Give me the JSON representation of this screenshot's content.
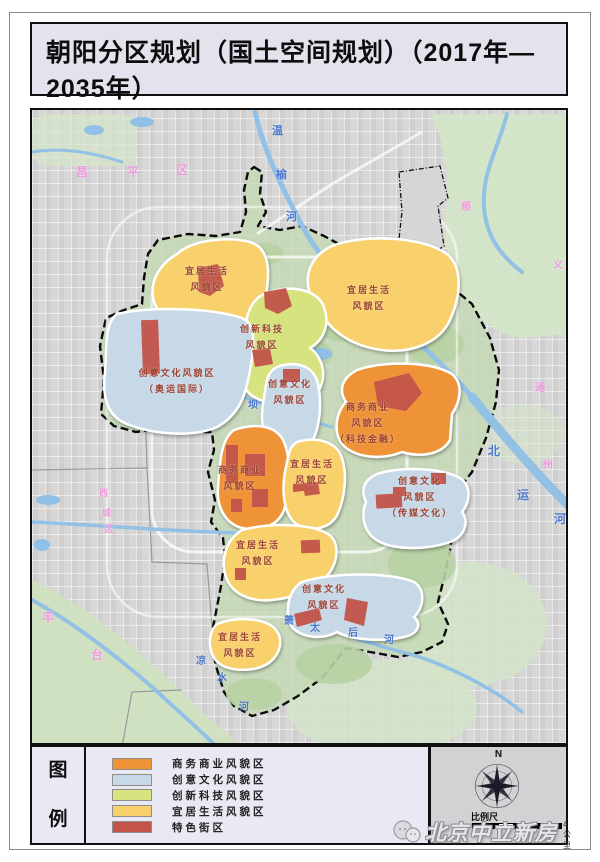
{
  "page": {
    "title": "朝阳分区规划（国土空间规划）（2017年—2035年）",
    "subtitle": "图15 风貌分区规划图"
  },
  "legend": {
    "heading": "图\n例",
    "items": [
      {
        "label": "商务商业风貌区",
        "color": "#ef9339",
        "type": "commerce"
      },
      {
        "label": "创意文化风貌区",
        "color": "#c7d8e7",
        "type": "culture"
      },
      {
        "label": "创新科技风貌区",
        "color": "#d6e37f",
        "type": "tech"
      },
      {
        "label": "宜居生活风貌区",
        "color": "#f8d06c",
        "type": "living"
      },
      {
        "label": "特色街区",
        "color": "#c2544a",
        "type": "special"
      }
    ]
  },
  "map": {
    "zone_labels": {
      "z1": "宜居生活\n风貌区",
      "z2": "宜居生活\n风貌区",
      "z3": "创新科技\n风貌区",
      "z4": "创意文化风貌区\n（奥运国际）",
      "z5": "创意文化\n风貌区",
      "z6": "商务商业\n风貌区\n（科技金融）",
      "z7": "商务商业\n风貌区",
      "z8": "宜居生活\n风貌区",
      "z9": "创意文化\n风貌区\n（传媒文化）",
      "z10": "宜居生活\n风貌区",
      "z11": "创意文化\n风貌区",
      "z12": "宜居生活\n风貌区"
    },
    "float_labels": [
      {
        "t": "温",
        "x": 270,
        "y": 120,
        "c": "#4d79cc",
        "s": 11
      },
      {
        "t": "榆",
        "x": 274,
        "y": 164,
        "c": "#4d79cc",
        "s": 11
      },
      {
        "t": "河",
        "x": 284,
        "y": 206,
        "c": "#4d79cc",
        "s": 11
      },
      {
        "t": "北",
        "x": 486,
        "y": 440,
        "c": "#4d79cc",
        "s": 12
      },
      {
        "t": "运",
        "x": 515,
        "y": 484,
        "c": "#4d79cc",
        "s": 12
      },
      {
        "t": "河",
        "x": 552,
        "y": 508,
        "c": "#4d79cc",
        "s": 12
      },
      {
        "t": "坝",
        "x": 246,
        "y": 394,
        "c": "#4d79cc",
        "s": 10
      },
      {
        "t": "萧",
        "x": 282,
        "y": 610,
        "c": "#4d79cc",
        "s": 10
      },
      {
        "t": "太",
        "x": 308,
        "y": 617,
        "c": "#4d79cc",
        "s": 10
      },
      {
        "t": "后",
        "x": 346,
        "y": 622,
        "c": "#4d79cc",
        "s": 10
      },
      {
        "t": "河",
        "x": 382,
        "y": 629,
        "c": "#4d79cc",
        "s": 10
      },
      {
        "t": "凉",
        "x": 194,
        "y": 650,
        "c": "#4d79cc",
        "s": 10
      },
      {
        "t": "水",
        "x": 215,
        "y": 667,
        "c": "#4d79cc",
        "s": 10
      },
      {
        "t": "河",
        "x": 237,
        "y": 696,
        "c": "#4d79cc",
        "s": 10
      },
      {
        "t": "昌",
        "x": 74,
        "y": 161,
        "c": "#ef9ade",
        "s": 12
      },
      {
        "t": "平",
        "x": 125,
        "y": 161,
        "c": "#ef9ade",
        "s": 12
      },
      {
        "t": "区",
        "x": 174,
        "y": 159,
        "c": "#ef9ade",
        "s": 12
      },
      {
        "t": "西",
        "x": 97,
        "y": 484,
        "c": "#ef9ade",
        "s": 9
      },
      {
        "t": "城",
        "x": 100,
        "y": 504,
        "c": "#ef9ade",
        "s": 9
      },
      {
        "t": "区",
        "x": 102,
        "y": 520,
        "c": "#ef9ade",
        "s": 9
      },
      {
        "t": "丰",
        "x": 40,
        "y": 606,
        "c": "#ef9ade",
        "s": 12
      },
      {
        "t": "台",
        "x": 89,
        "y": 644,
        "c": "#ef9ade",
        "s": 12
      },
      {
        "t": "顺",
        "x": 459,
        "y": 196,
        "c": "#ef9ade",
        "s": 10
      },
      {
        "t": "义",
        "x": 551,
        "y": 254,
        "c": "#ef9ade",
        "s": 10
      },
      {
        "t": "通",
        "x": 533,
        "y": 377,
        "c": "#ef9ade",
        "s": 10
      },
      {
        "t": "州",
        "x": 541,
        "y": 454,
        "c": "#ef9ade",
        "s": 10
      }
    ]
  },
  "scale": {
    "compass_label": "N",
    "label": "比例尺",
    "distance": "4公里"
  },
  "watermark": {
    "text": "北京中立新房"
  }
}
